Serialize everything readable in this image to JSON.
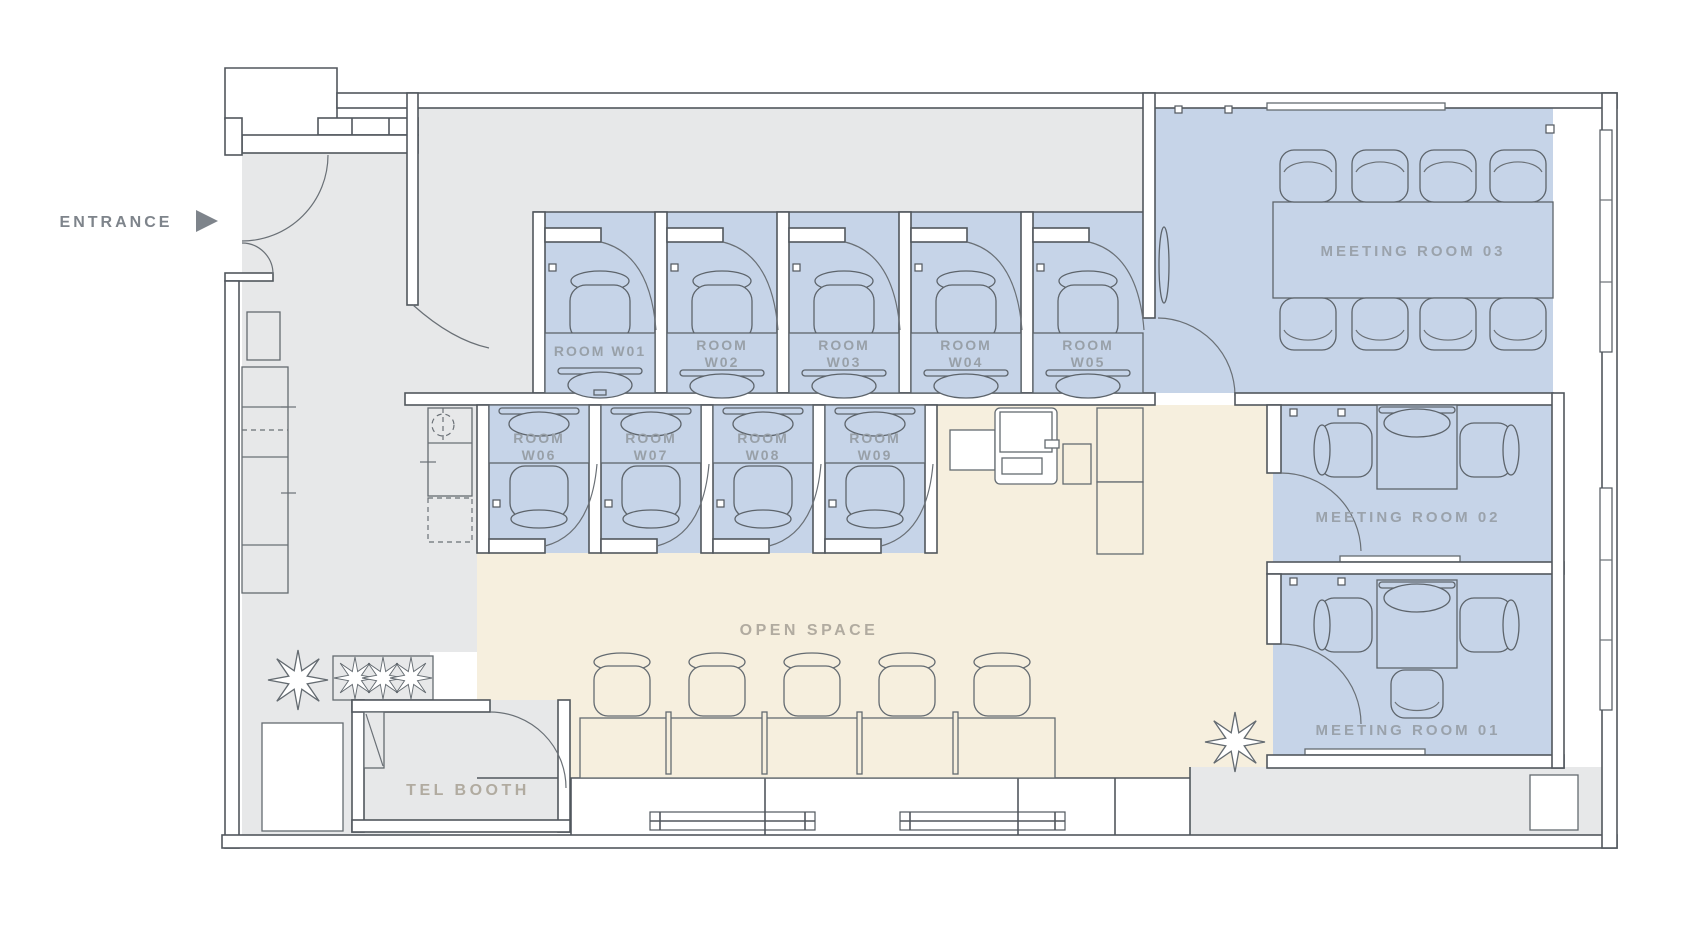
{
  "labels": {
    "entrance": "ENTRANCE",
    "open_space": "OPEN SPACE",
    "tel_booth": "TEL BOOTH"
  },
  "meeting_rooms": {
    "m01": {
      "label": "MEETING ROOM 01"
    },
    "m02": {
      "label": "MEETING ROOM 02"
    },
    "m03": {
      "label": "MEETING ROOM 03"
    }
  },
  "work_rooms": {
    "w01": {
      "line1": "ROOM W01"
    },
    "w02": {
      "line1": "ROOM",
      "line2": "W02"
    },
    "w03": {
      "line1": "ROOM",
      "line2": "W03"
    },
    "w04": {
      "line1": "ROOM",
      "line2": "W04"
    },
    "w05": {
      "line1": "ROOM",
      "line2": "W05"
    },
    "w06": {
      "line1": "ROOM",
      "line2": "W06"
    },
    "w07": {
      "line1": "ROOM",
      "line2": "W07"
    },
    "w08": {
      "line1": "ROOM",
      "line2": "W08"
    },
    "w09": {
      "line1": "ROOM",
      "line2": "W09"
    }
  },
  "colors": {
    "background": "#ffffff",
    "room_highlight": "#c6d4e8",
    "open_space": "#f6efde",
    "corridor": "#e7e8e9",
    "wall_line": "#51575d",
    "furniture_line": "#646b71",
    "label_area": "#b1aba0",
    "label_room": "#98a0a8",
    "entrance_label": "#7e848b"
  }
}
